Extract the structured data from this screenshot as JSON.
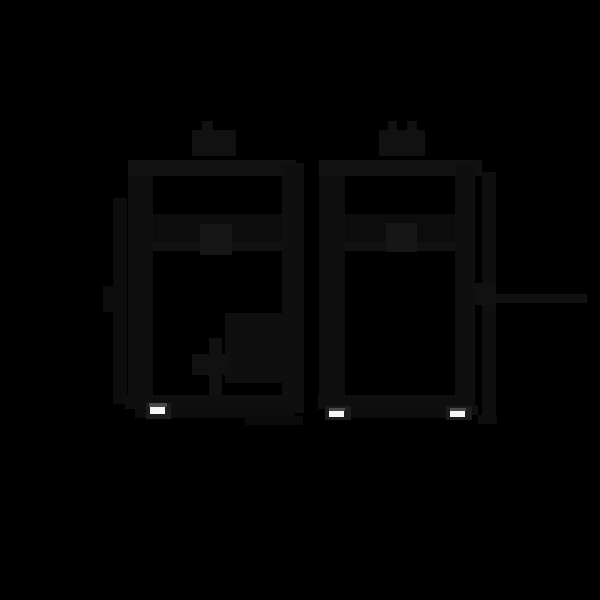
{
  "canvas": {
    "width": 600,
    "height": 600,
    "background": "#000000"
  },
  "palette": {
    "ink": "#111111",
    "ink_dark": "#0d0d0d",
    "ink_mid": "#0f0f0f",
    "ink_light": "#161616",
    "panel": "#0c0c0c",
    "shadow": "#0b0b0b",
    "frame": "#1c1c1c",
    "foot_white": "#f7f7f7",
    "foot_gray": "#4a4a4a"
  },
  "figure": {
    "description": "Two near-black technical outline illustrations of boiler-style appliances on a black background, each with roof flue stubs, a front control knob on a horizontal divider, side dimension lines, and small white leveling feet.",
    "units": [
      {
        "name": "left-unit",
        "shapes": [
          {
            "name": "flue-stub",
            "x": 202,
            "y": 121,
            "w": 11,
            "h": 11,
            "color": "ink"
          },
          {
            "name": "flue-collar",
            "x": 192,
            "y": 130,
            "w": 44,
            "h": 26,
            "color": "ink"
          },
          {
            "name": "top-bar",
            "x": 128,
            "y": 160,
            "w": 168,
            "h": 16,
            "color": "ink"
          },
          {
            "name": "left-dim-line",
            "x": 113,
            "y": 198,
            "w": 14,
            "h": 206,
            "color": "ink_dark"
          },
          {
            "name": "left-dim-stub",
            "x": 103,
            "y": 286,
            "w": 11,
            "h": 26,
            "color": "ink_dark"
          },
          {
            "name": "left-wall",
            "x": 128,
            "y": 176,
            "w": 25,
            "h": 226,
            "color": "ink_mid"
          },
          {
            "name": "right-wall",
            "x": 282,
            "y": 163,
            "w": 22,
            "h": 250,
            "color": "ink_mid"
          },
          {
            "name": "panel-top",
            "x": 153,
            "y": 214,
            "w": 129,
            "h": 30,
            "color": "panel"
          },
          {
            "name": "panel-divider",
            "x": 153,
            "y": 242,
            "w": 129,
            "h": 9,
            "color": "ink"
          },
          {
            "name": "control-knob",
            "x": 200,
            "y": 224,
            "w": 32,
            "h": 31,
            "color": "ink_light"
          },
          {
            "name": "burner-assembly",
            "x": 225,
            "y": 313,
            "w": 57,
            "h": 70,
            "color": "ink_mid"
          },
          {
            "name": "pipe-vertical",
            "x": 209,
            "y": 338,
            "w": 13,
            "h": 57,
            "color": "ink"
          },
          {
            "name": "pipe-valve",
            "x": 192,
            "y": 354,
            "w": 36,
            "h": 21,
            "color": "ink"
          },
          {
            "name": "bottom-bar",
            "x": 125,
            "y": 395,
            "w": 179,
            "h": 14,
            "color": "ink_mid"
          },
          {
            "name": "bottom-lip",
            "x": 135,
            "y": 409,
            "w": 160,
            "h": 9,
            "color": "ink_dark"
          },
          {
            "name": "under-shadow",
            "x": 245,
            "y": 416,
            "w": 58,
            "h": 9,
            "color": "shadow"
          },
          {
            "name": "foot-frame",
            "x": 146,
            "y": 403,
            "w": 25,
            "h": 16,
            "color": "frame"
          },
          {
            "name": "foot-gray-strip",
            "x": 149,
            "y": 403,
            "w": 18,
            "h": 4,
            "color": "foot_gray"
          },
          {
            "name": "foot-highlight",
            "x": 150,
            "y": 407,
            "w": 15,
            "h": 7,
            "color": "foot_white"
          }
        ]
      },
      {
        "name": "right-unit",
        "shapes": [
          {
            "name": "flue-stub-left",
            "x": 388,
            "y": 121,
            "w": 9,
            "h": 10,
            "color": "ink"
          },
          {
            "name": "flue-stub-right",
            "x": 407,
            "y": 121,
            "w": 10,
            "h": 10,
            "color": "ink"
          },
          {
            "name": "flue-collar",
            "x": 379,
            "y": 130,
            "w": 46,
            "h": 26,
            "color": "ink"
          },
          {
            "name": "top-bar",
            "x": 319,
            "y": 160,
            "w": 163,
            "h": 16,
            "color": "ink"
          },
          {
            "name": "right-dim-line",
            "x": 482,
            "y": 172,
            "w": 14,
            "h": 246,
            "color": "ink_mid"
          },
          {
            "name": "left-wall",
            "x": 319,
            "y": 176,
            "w": 26,
            "h": 226,
            "color": "ink_mid"
          },
          {
            "name": "right-wall",
            "x": 455,
            "y": 163,
            "w": 20,
            "h": 250,
            "color": "ink_mid"
          },
          {
            "name": "panel-top",
            "x": 345,
            "y": 214,
            "w": 110,
            "h": 30,
            "color": "panel"
          },
          {
            "name": "panel-divider",
            "x": 345,
            "y": 242,
            "w": 110,
            "h": 9,
            "color": "ink"
          },
          {
            "name": "control-knob",
            "x": 386,
            "y": 223,
            "w": 31,
            "h": 29,
            "color": "ink_light"
          },
          {
            "name": "callout-block",
            "x": 475,
            "y": 283,
            "w": 21,
            "h": 22,
            "color": "ink"
          },
          {
            "name": "callout-line",
            "x": 496,
            "y": 294,
            "w": 91,
            "h": 9,
            "color": "ink"
          },
          {
            "name": "bottom-bar",
            "x": 318,
            "y": 395,
            "w": 157,
            "h": 14,
            "color": "ink_mid"
          },
          {
            "name": "bottom-lip",
            "x": 328,
            "y": 409,
            "w": 140,
            "h": 9,
            "color": "ink_dark"
          },
          {
            "name": "dim-bottom-hook-a",
            "x": 467,
            "y": 405,
            "w": 11,
            "h": 10,
            "color": "ink_mid"
          },
          {
            "name": "dim-bottom-hook-b",
            "x": 478,
            "y": 415,
            "w": 19,
            "h": 9,
            "color": "ink_mid"
          },
          {
            "name": "foot-frame-left",
            "x": 325,
            "y": 406,
            "w": 26,
            "h": 14,
            "color": "frame"
          },
          {
            "name": "foot-gray-left",
            "x": 329,
            "y": 408,
            "w": 16,
            "h": 3,
            "color": "foot_gray"
          },
          {
            "name": "foot-white-left",
            "x": 329,
            "y": 411,
            "w": 15,
            "h": 6,
            "color": "foot_white"
          },
          {
            "name": "foot-frame-right",
            "x": 446,
            "y": 406,
            "w": 26,
            "h": 14,
            "color": "frame"
          },
          {
            "name": "foot-gray-right",
            "x": 450,
            "y": 408,
            "w": 16,
            "h": 3,
            "color": "foot_gray"
          },
          {
            "name": "foot-white-right",
            "x": 450,
            "y": 411,
            "w": 15,
            "h": 6,
            "color": "foot_white"
          }
        ]
      }
    ]
  }
}
